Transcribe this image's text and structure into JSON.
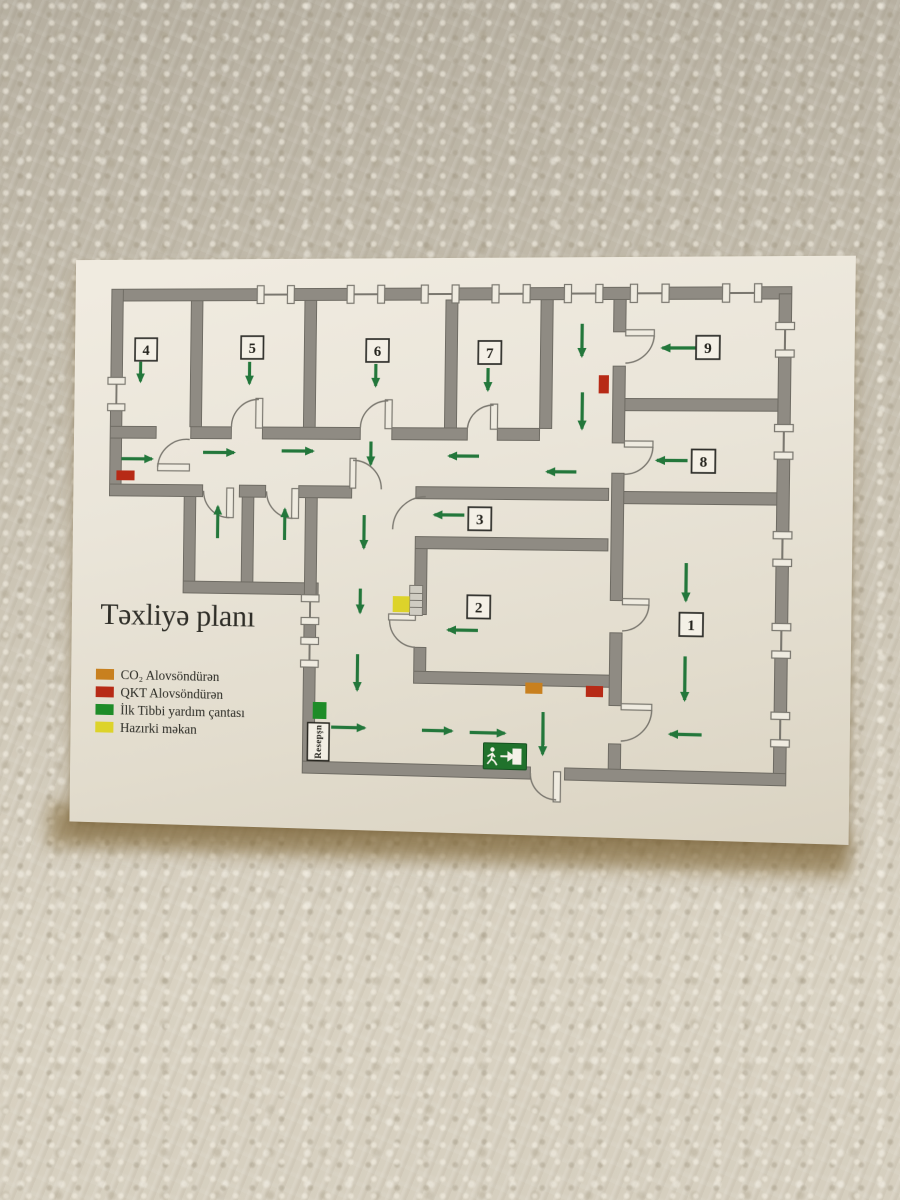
{
  "sign": {
    "title": "Təxliyə planı",
    "legend": {
      "items": [
        {
          "name": "co2-extinguisher",
          "label": "CO₂ Alovsöndürən",
          "color": "#c8801f"
        },
        {
          "name": "qkt-extinguisher",
          "label": "QKT Alovsöndürən",
          "color": "#b72a16"
        },
        {
          "name": "first-aid-kit",
          "label": "İlk Tibbi yardım çantası",
          "color": "#1e8c28"
        },
        {
          "name": "current-location",
          "label": "Hazırki məkan",
          "color": "#ddd32a"
        }
      ]
    },
    "plan": {
      "room_numbers": [
        "1",
        "2",
        "3",
        "4",
        "5",
        "6",
        "7",
        "8",
        "9"
      ],
      "reception_label": "Resepşn",
      "icons": {
        "exit_sign": "running-man-exit-right"
      },
      "colors": {
        "wall": "#8f8b83",
        "arrow": "#23773b",
        "exit_sign_green": "#20722c"
      }
    }
  }
}
